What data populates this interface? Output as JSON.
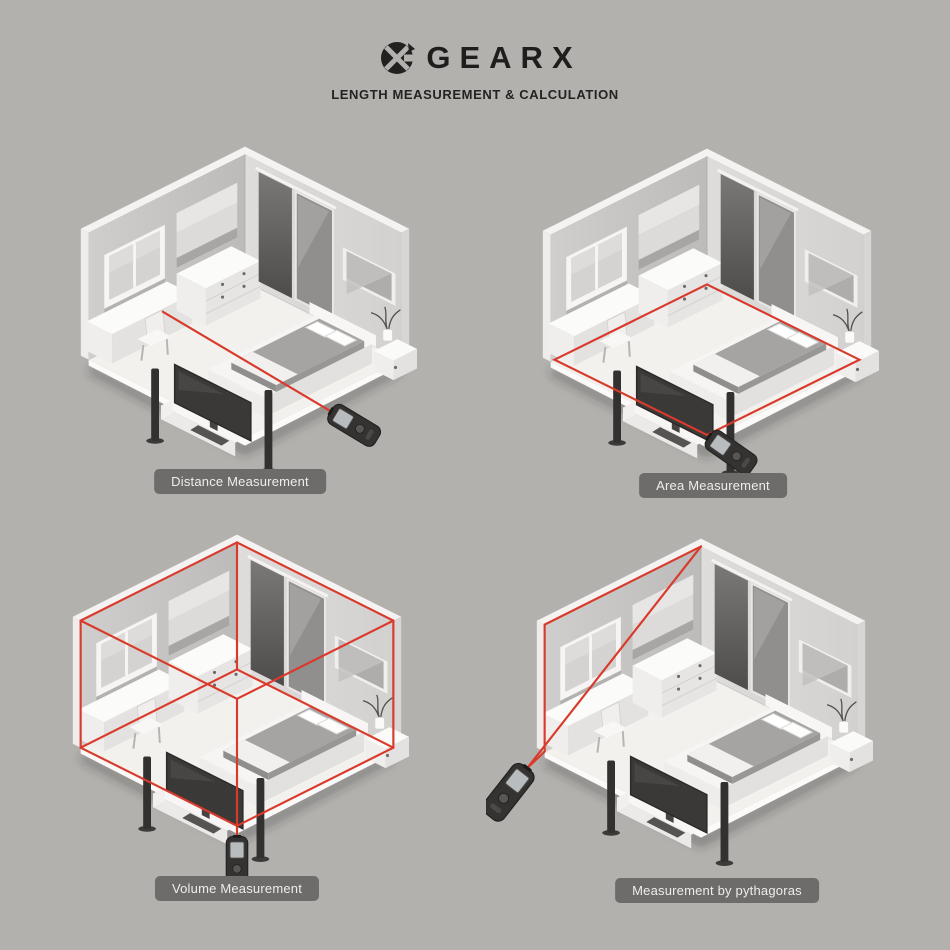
{
  "header": {
    "brand": "GEARX",
    "subtitle": "LENGTH MEASUREMENT & CALCULATION",
    "logo_icon": "gearx-circle-x-icon"
  },
  "figures": [
    {
      "mode": "distance",
      "label": "Distance Measurement"
    },
    {
      "mode": "area",
      "label": "Area Measurement"
    },
    {
      "mode": "volume",
      "label": "Volume Measurement"
    },
    {
      "mode": "pythagoras",
      "label": "Measurement by pythagoras"
    }
  ],
  "icons": [
    {
      "name": "gearx-circle-x-icon",
      "glyph": "black circle with X cut-out"
    },
    {
      "name": "laser-device-icon",
      "glyph": "handheld laser distance meter"
    }
  ],
  "colors": {
    "background": "#b3b1ae",
    "laser_red": "#d93a2c",
    "label_badge": "#6d6c6a",
    "label_text": "#eeedec",
    "ink": "#1f1e1d",
    "wall_light": "#dbdad8",
    "wall_mid": "#c6c5c3",
    "floor": "#f2f1ee",
    "device_body": "#343332"
  }
}
